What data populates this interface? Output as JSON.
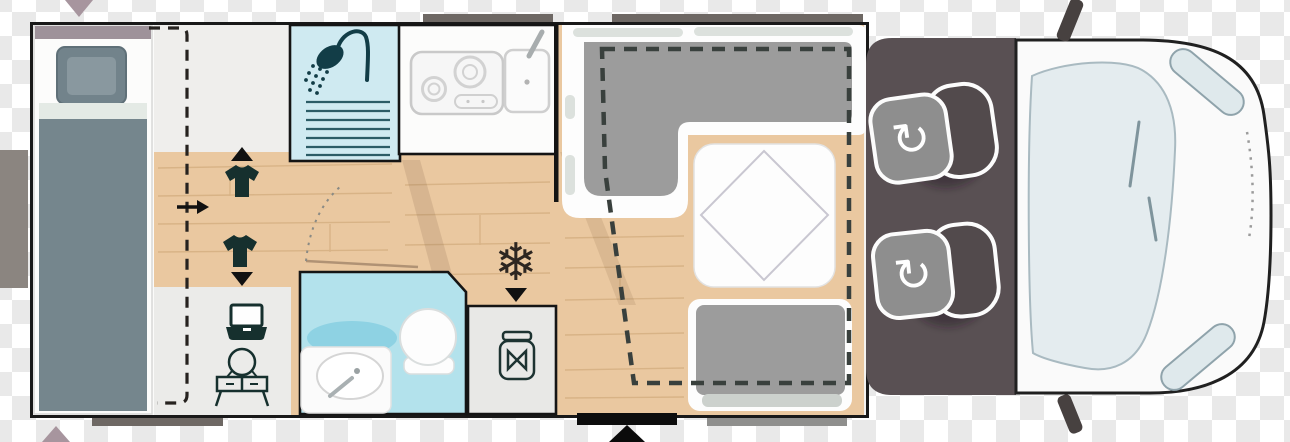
{
  "scene": {
    "type": "motorhome-floorplan-top-view",
    "visible_text": "none",
    "glyphs": {
      "rotate_arrow": "↻",
      "snowflake": "❄"
    }
  },
  "palette": {
    "checker_light": "#ffffff",
    "checker_dark": "#e9e9e9",
    "wall": "#191919",
    "interior": "#f4f3f1",
    "wood_floor": "#eac8a0",
    "wood_grain": "#b98d57",
    "shower_blue": "#cfeaf1",
    "bath_blue": "#b3e2ec",
    "bath_accent": "#8ed2e3",
    "icon_dark": "#16302e",
    "shower_icon_dark": "#123d47",
    "bed_blanket": "#75868d",
    "bed_pillow": "#72838b",
    "bed_sheet": "#e4eae5",
    "mauve_marker": "#a7959e",
    "head_wall": "#9e929a",
    "sofa_gray": "#9c9c9c",
    "cushion_light": "#dce1dd",
    "bench_strip": "#ccd1cd",
    "table_line": "#c9c7d1",
    "cab_floor": "#595053",
    "seat_cushion": "#8e8e8e",
    "seat_backrest": "#524a4c",
    "seat_outline": "#fcfcfc",
    "vehicle_body": "#fafafa",
    "vehicle_outline": "#202020",
    "glass": "#e4ecef",
    "glass_edge": "#a9bac1",
    "mirror": "#474140",
    "window_bar": "#6e6864",
    "skirt_bar": "#8f8f8d",
    "entry_step": "#0d0d0d",
    "dashed_line": "#39403d"
  },
  "icons": [
    "down-triangle-marker",
    "up-triangle-marker",
    "shower-head-icon",
    "stove-icon",
    "sink-faucet-icon",
    "wardrobe-up-arrow-icon",
    "t-shirt-icon-top",
    "direction-right-arrow-icon",
    "t-shirt-icon-bottom",
    "wardrobe-down-arrow-icon",
    "laptop-icon",
    "vanity-table-icon",
    "washbasin-icon",
    "toilet-icon",
    "snowflake-fridge-icon",
    "fridge-down-arrow-icon",
    "food-jar-pantry-icon",
    "drop-down-bed-dashed-outline",
    "sliding-partition-dashed-line",
    "l-shaped-sofa",
    "dinette-table",
    "side-bench",
    "rear-bed",
    "swivel-seat-front",
    "swivel-seat-rear",
    "entry-door-arrow-icon",
    "windshield",
    "headlight",
    "side-mirror",
    "door-swing-arc"
  ]
}
